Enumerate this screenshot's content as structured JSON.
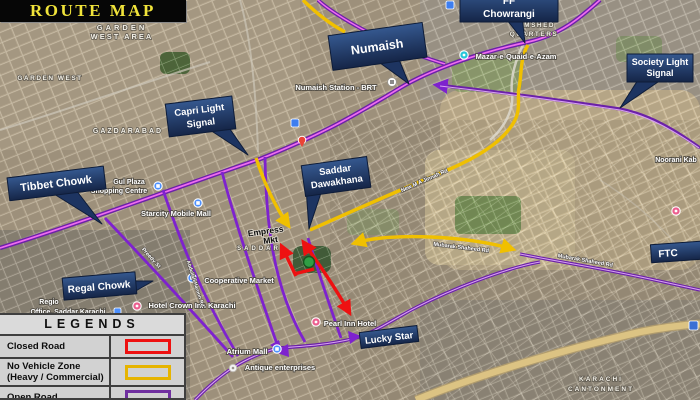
{
  "title": "ROUTE MAP",
  "colors": {
    "closed_road": "#ee1111",
    "no_vehicle_zone": "#f0c000",
    "open_road_casing": "#6b21a8",
    "open_road_core": "#ef6bf0",
    "callout_bg": "#1f3864",
    "title_text": "#f0e33a",
    "green_marker": "#2f9e44"
  },
  "legend": {
    "header": "LEGENDS",
    "rows": [
      {
        "label": "Closed Road"
      },
      {
        "label": "No Vehicle Zone",
        "label2": "(Heavy / Commercial)"
      },
      {
        "label": "Open Road"
      }
    ]
  },
  "callouts": {
    "numaish": "Numaish",
    "ff_line1": "FF",
    "ff_line2": "Chowrangi",
    "society_line1": "Society Light",
    "society_line2": "Signal",
    "capri_line1": "Capri Light",
    "capri_line2": "Signal",
    "tibbet": "Tibbet Chowk",
    "saddar_line1": "Saddar",
    "saddar_line2": "Dawakhana",
    "regal": "Regal Chowk",
    "lucky": "Lucky Star",
    "ftc": "FTC"
  },
  "map_labels": {
    "garden_area_1": "GARDEN",
    "garden_area_2": "WEST AREA",
    "garden_west": "GARDEN WEST",
    "gazdarabad": "GAZDARABAD",
    "numaish_station": "Numaish Station - BRT",
    "mazar": "Mazar-e-Quaid-e-Azam",
    "jamshed_1": "JAMSHED",
    "jamshed_2": "QUARTERS",
    "noorani": "Noorani Kab",
    "gul_1": "Gul Plaza",
    "gul_2": "Shopping Centre",
    "starcity": "Starcity Mobile Mall",
    "empress_1": "Empress",
    "empress_2": "Mkt",
    "saddar_area": "SADDAR",
    "coop": "Cooperative Market",
    "crown": "Hotel Crown Inn Karachi",
    "regio_1": "Regio",
    "regio_2": "Office, Saddar Karachi",
    "pearl": "Pearl Inn Hotel",
    "atrium": "Atrium Mall",
    "antique": "Antique enterprises",
    "cantt_1": "KARACHI",
    "cantt_2": "CANTONMENT",
    "mubarak_1": "Mubarak Shaheed Rd",
    "mubarak_2": "Mubarak Shaheed Rd",
    "new_maj": "New M A Jinnah Rd",
    "preedy": "Preedy St",
    "abdullah": "Abdullah Haroon Rd"
  }
}
